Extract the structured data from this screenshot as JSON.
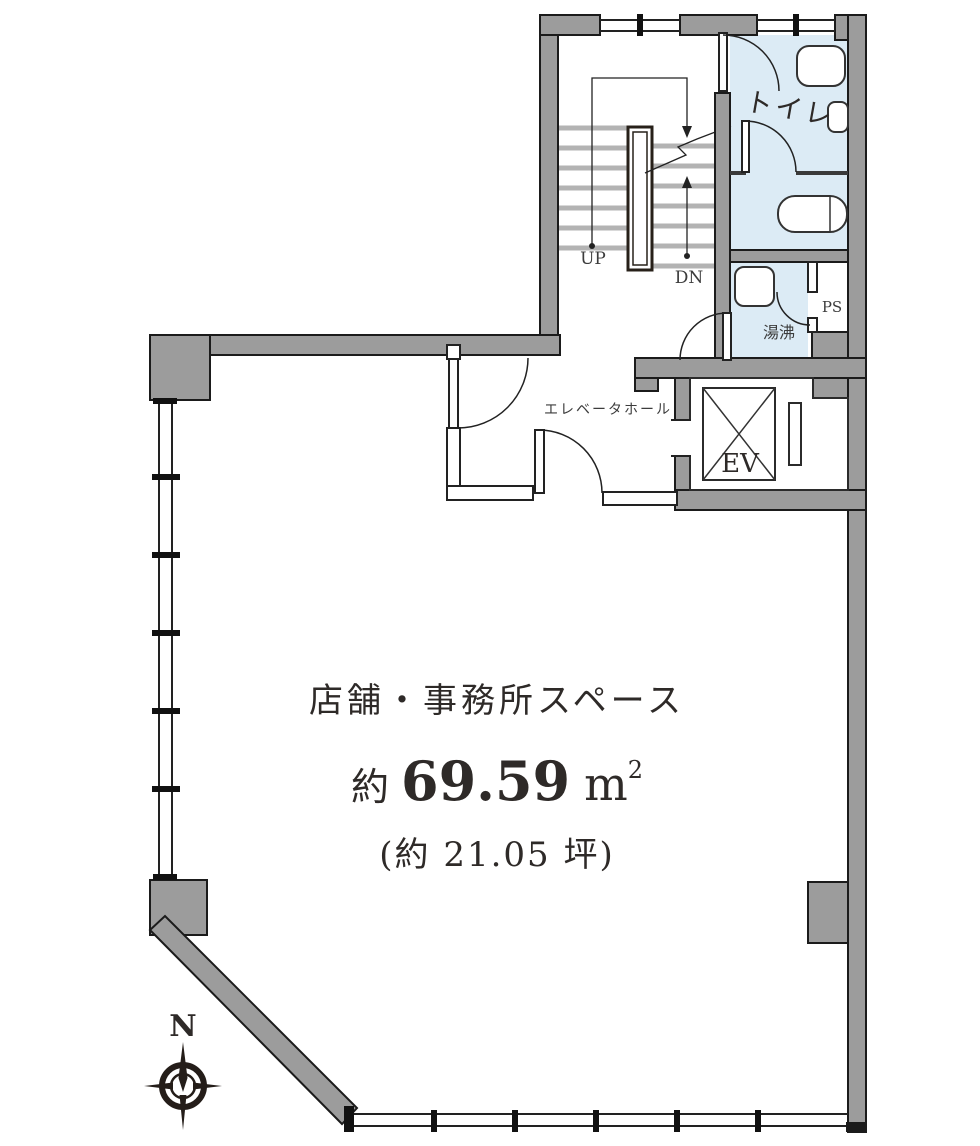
{
  "colors": {
    "wall": "#9c9c9c",
    "wall_outline": "#1b1b1b",
    "room_fill": "#dcebf5",
    "tread": "#b3b3b3",
    "line": "#222222",
    "text": "#2e2a28"
  },
  "labels": {
    "toilet": "トイレ",
    "kitchenette": "湯沸",
    "pipe_shaft": "PS",
    "elevator_hall": "エレベータホール",
    "elevator": "EV",
    "stairs_up": "UP",
    "stairs_down": "DN",
    "north": "N"
  },
  "main_space": {
    "name": "店舗・事務所スペース",
    "area_prefix": "約",
    "area_value": "69.59",
    "area_unit_base": "m",
    "area_unit_exponent": "2",
    "area_tsubo": "(約 21.05 坪)"
  }
}
